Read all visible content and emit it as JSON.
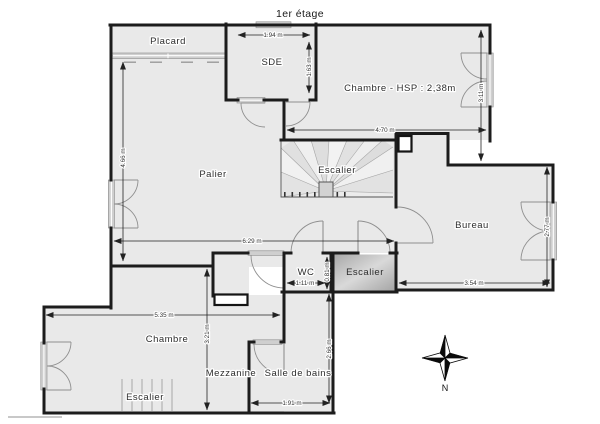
{
  "title": "1er étage",
  "rooms": {
    "placard": "Placard",
    "sde": "SDE",
    "chambre_top": "Chambre - HSP : 2,38m",
    "palier": "Palier",
    "escalier_spiral": "Escalier",
    "bureau": "Bureau",
    "wc": "WC",
    "escalier_mid": "Escalier",
    "chambre_bottom": "Chambre",
    "mezzanine": "Mezzanine",
    "salle_de_bains": "Salle de bains",
    "escalier_bottom": "Escalier"
  },
  "dimensions": {
    "sde_width": "1.94 m",
    "sde_depth": "1.63 m",
    "chambre_top_depth": "3.11 m",
    "chambre_top_width": "4.70 m",
    "palier_depth": "4.66 m",
    "palier_width": "6.29 m",
    "wc_width": "1.11 m",
    "wc_depth": "0.81 m",
    "bureau_width": "3.54 m",
    "bureau_depth": "2.77 m",
    "chambre_bottom_width": "5.35 m",
    "chambre_bottom_depth": "3.21 m",
    "salle_de_bains_depth": "2.66 m",
    "salle_de_bains_width": "1.91 m"
  },
  "compass": {
    "north_label": "N"
  },
  "colors": {
    "wall": "#1c1c1c",
    "room_fill": "#e9e9e9",
    "stair_fill": "#bdbdbd",
    "window_band": "#cfcfcf",
    "dimension_text": "#333333"
  }
}
